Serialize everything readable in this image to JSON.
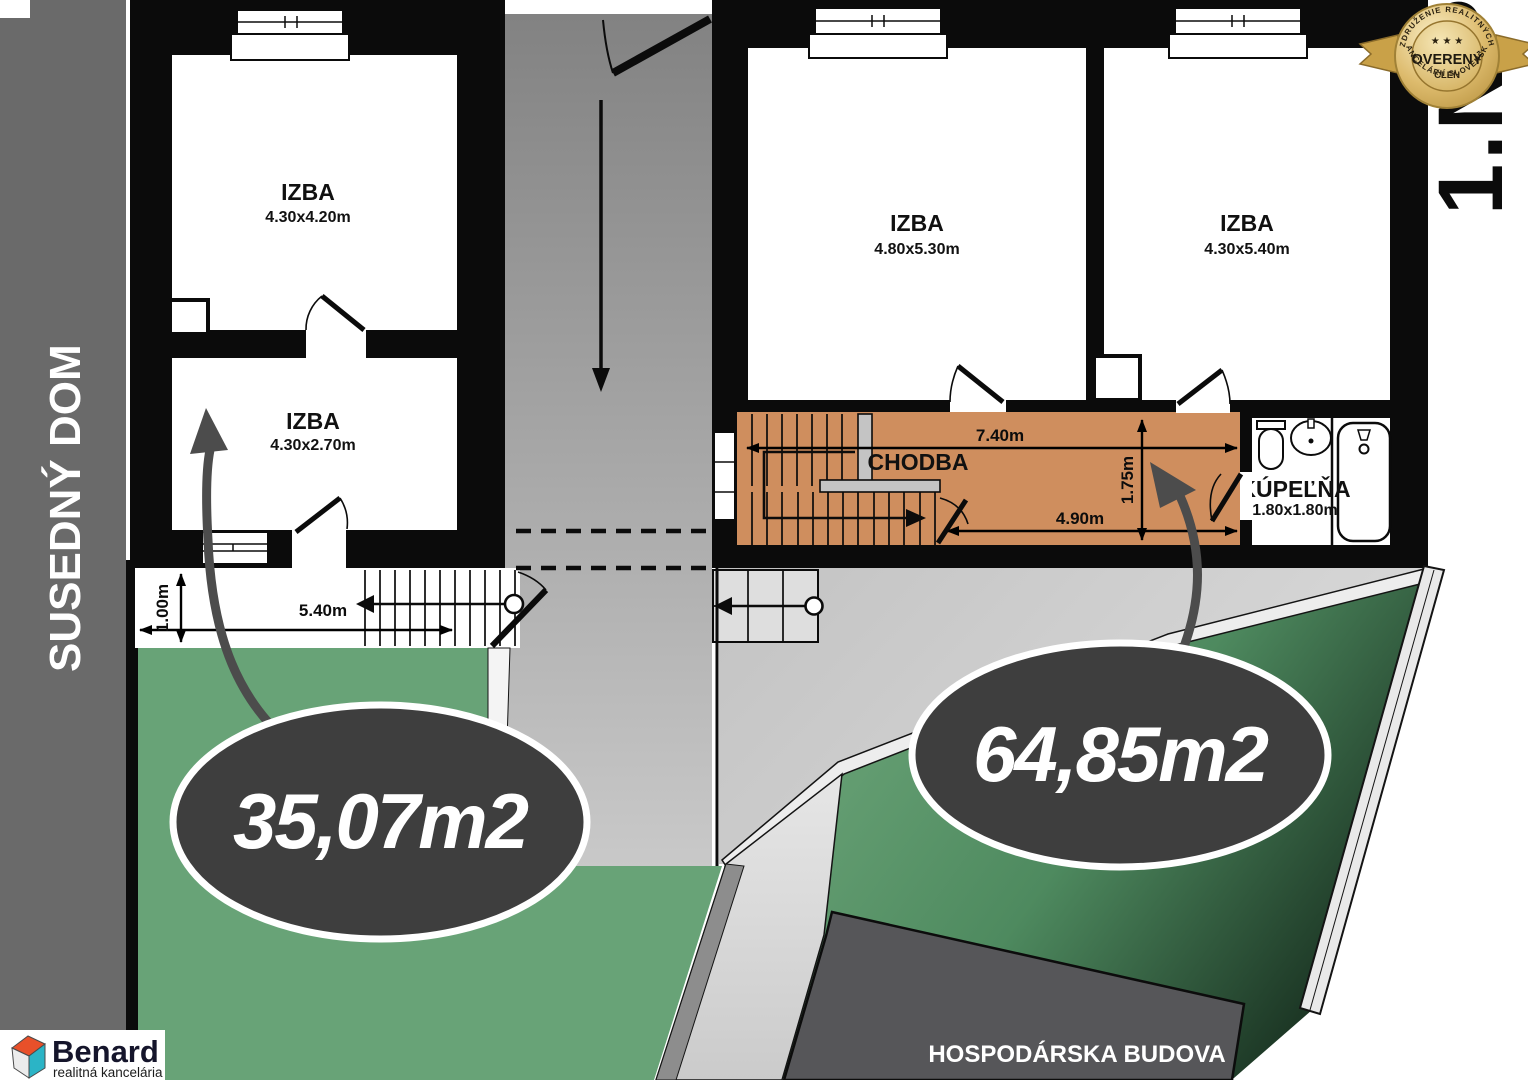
{
  "plan": {
    "floor_label": "1.NP",
    "neighbor_building": "SUSEDNÝ DOM",
    "outbuilding": "HOSPODÁRSKA BUDOVA",
    "rooms": [
      {
        "id": "izba-1",
        "name": "IZBA",
        "dims": "4.30x4.20m"
      },
      {
        "id": "izba-2",
        "name": "IZBA",
        "dims": "4.30x2.70m"
      },
      {
        "id": "izba-3",
        "name": "IZBA",
        "dims": "4.80x5.30m"
      },
      {
        "id": "izba-4",
        "name": "IZBA",
        "dims": "4.30x5.40m"
      },
      {
        "id": "chodba",
        "name": "CHODBA",
        "dims": ""
      },
      {
        "id": "kupelna",
        "name": "KÚPEĽŇA",
        "dims": "1.80x1.80m"
      }
    ],
    "area_labels": [
      {
        "value": "35,07m2"
      },
      {
        "value": "64,85m2"
      }
    ],
    "measurements": {
      "path_width": "1.00m",
      "path_length": "5.40m",
      "corridor_total": "7.40m",
      "corridor_partial": "4.90m",
      "corridor_width": "1.75m"
    }
  },
  "badge": {
    "arc_top": "ZDRUŽENIE REALITNÝCH",
    "arc_bottom": "KANCELÁRIÍ SLOVENSKA",
    "stars": "★ ★ ★",
    "title": "OVERENÝ",
    "subtitle": "ČLEN"
  },
  "logo": {
    "brand": "Benard",
    "tagline": "realitná kancelária"
  },
  "colors": {
    "corridor_orange": "#cf8e5e",
    "yard_green": "#68a377",
    "ellipse_dark": "#3e3e3e",
    "outbuilding_gray": "#565659",
    "neighbor_gray": "#6a6a6a",
    "badge_gold": "#d9b766"
  }
}
